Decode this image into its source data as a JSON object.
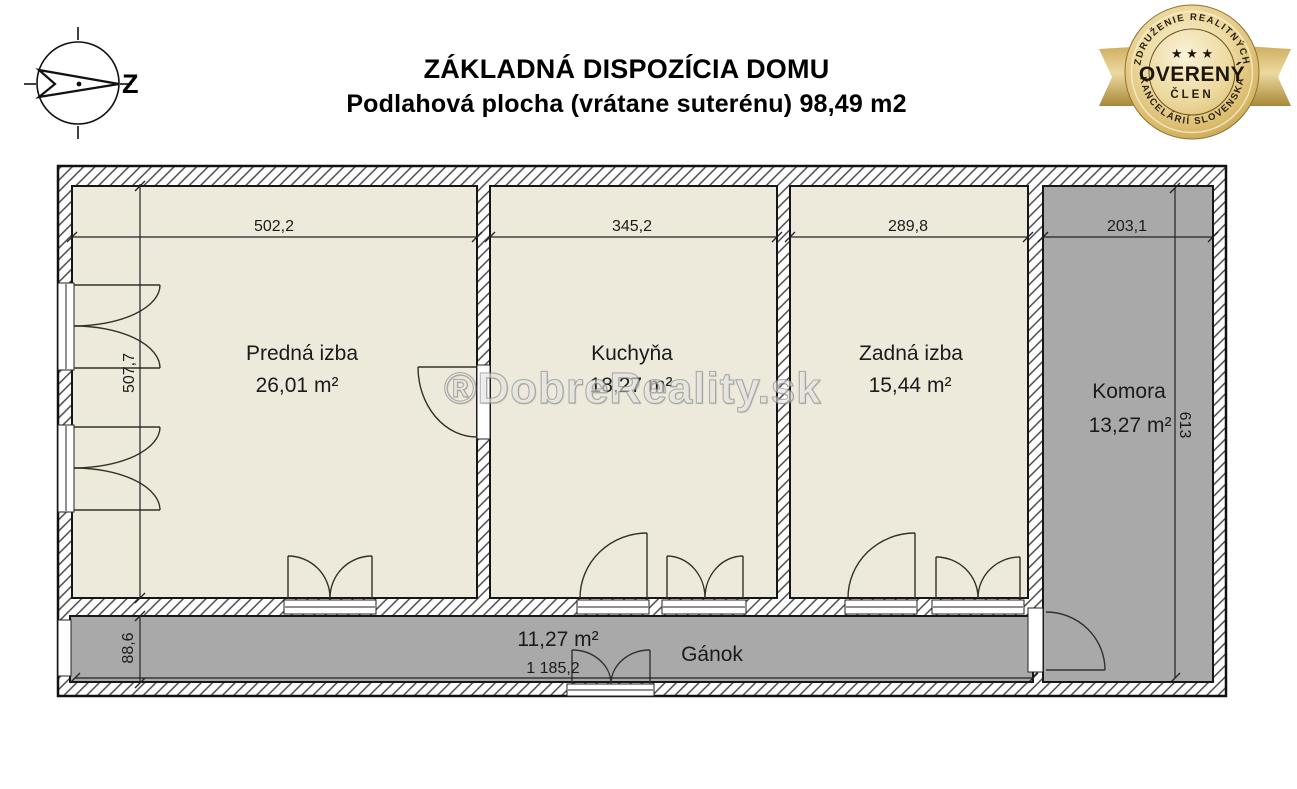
{
  "header": {
    "title_line1": "ZÁKLADNÁ DISPOZÍCIA DOMU",
    "title_line2": "Podlahová plocha (vrátane suterénu) 98,49 m2"
  },
  "compass": {
    "west_label": "Z"
  },
  "badge": {
    "arc_top": "ZDRUŽENIE REALITNÝCH",
    "arc_bottom": "KANCELÁRIÍ SLOVENSKA",
    "stars": "★ ★ ★",
    "title": "OVERENÝ",
    "subtitle": "ČLEN"
  },
  "watermark": "®DobreReality.sk",
  "floorplan": {
    "rooms": [
      {
        "name": "Predná izba",
        "area": "26,01 m²"
      },
      {
        "name": "Kuchyňa",
        "area": "18,27 m²"
      },
      {
        "name": "Zadná izba",
        "area": "15,44 m²"
      },
      {
        "name": "Komora",
        "area": "13,27 m²"
      },
      {
        "name": "Gánok",
        "area": "11,27 m²"
      }
    ],
    "dimensions": {
      "predna_width": "502,2",
      "kuchyna_width": "345,2",
      "zadna_width": "289,8",
      "komora_width": "203,1",
      "left_height": "507,7",
      "komora_height": "613",
      "ganok_height": "88,6",
      "ganok_width": "1 185,2"
    },
    "colors": {
      "room_fill": "#edeadb",
      "secondary_fill": "#a9a9a9",
      "wall_outline": "#161616"
    }
  }
}
